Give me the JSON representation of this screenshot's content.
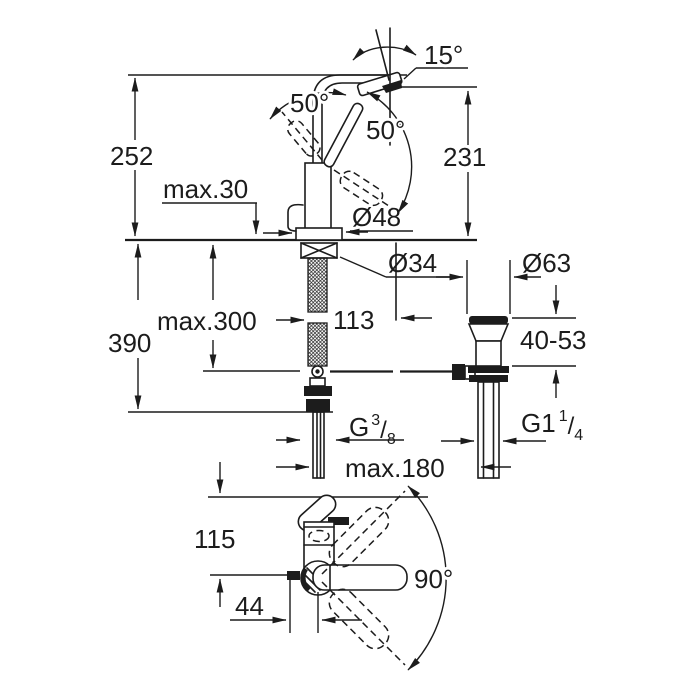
{
  "drawing": {
    "kind": "faucet-dimensional-drawing",
    "labels": {
      "angle_tip": "15°",
      "angle_lever_left": "50°",
      "angle_lever_right": "50°",
      "height_total": "252",
      "height_outlet": "231",
      "max_deck_thickness": "max.30",
      "dia_base": "Ø48",
      "dia_mount_hole": "Ø34",
      "dia_drain_flange": "Ø63",
      "depth_below_deck": "390",
      "max_hose_length": "max.300",
      "hose_length": "113",
      "drain_deck_range": "40-53",
      "supply_thread_g": "G",
      "supply_thread_sup": "3",
      "supply_thread_slash": "/",
      "supply_thread_sub": "8",
      "drain_thread_g": "G1",
      "drain_thread_sup": "1",
      "drain_thread_slash": "/",
      "drain_thread_sub": "4",
      "max_drain_distance": "max.180",
      "top_view_height": "115",
      "top_view_offset": "44",
      "angle_handle_swing": "90°"
    },
    "colors": {
      "line": "#1c1c1c",
      "background": "#ffffff"
    }
  }
}
